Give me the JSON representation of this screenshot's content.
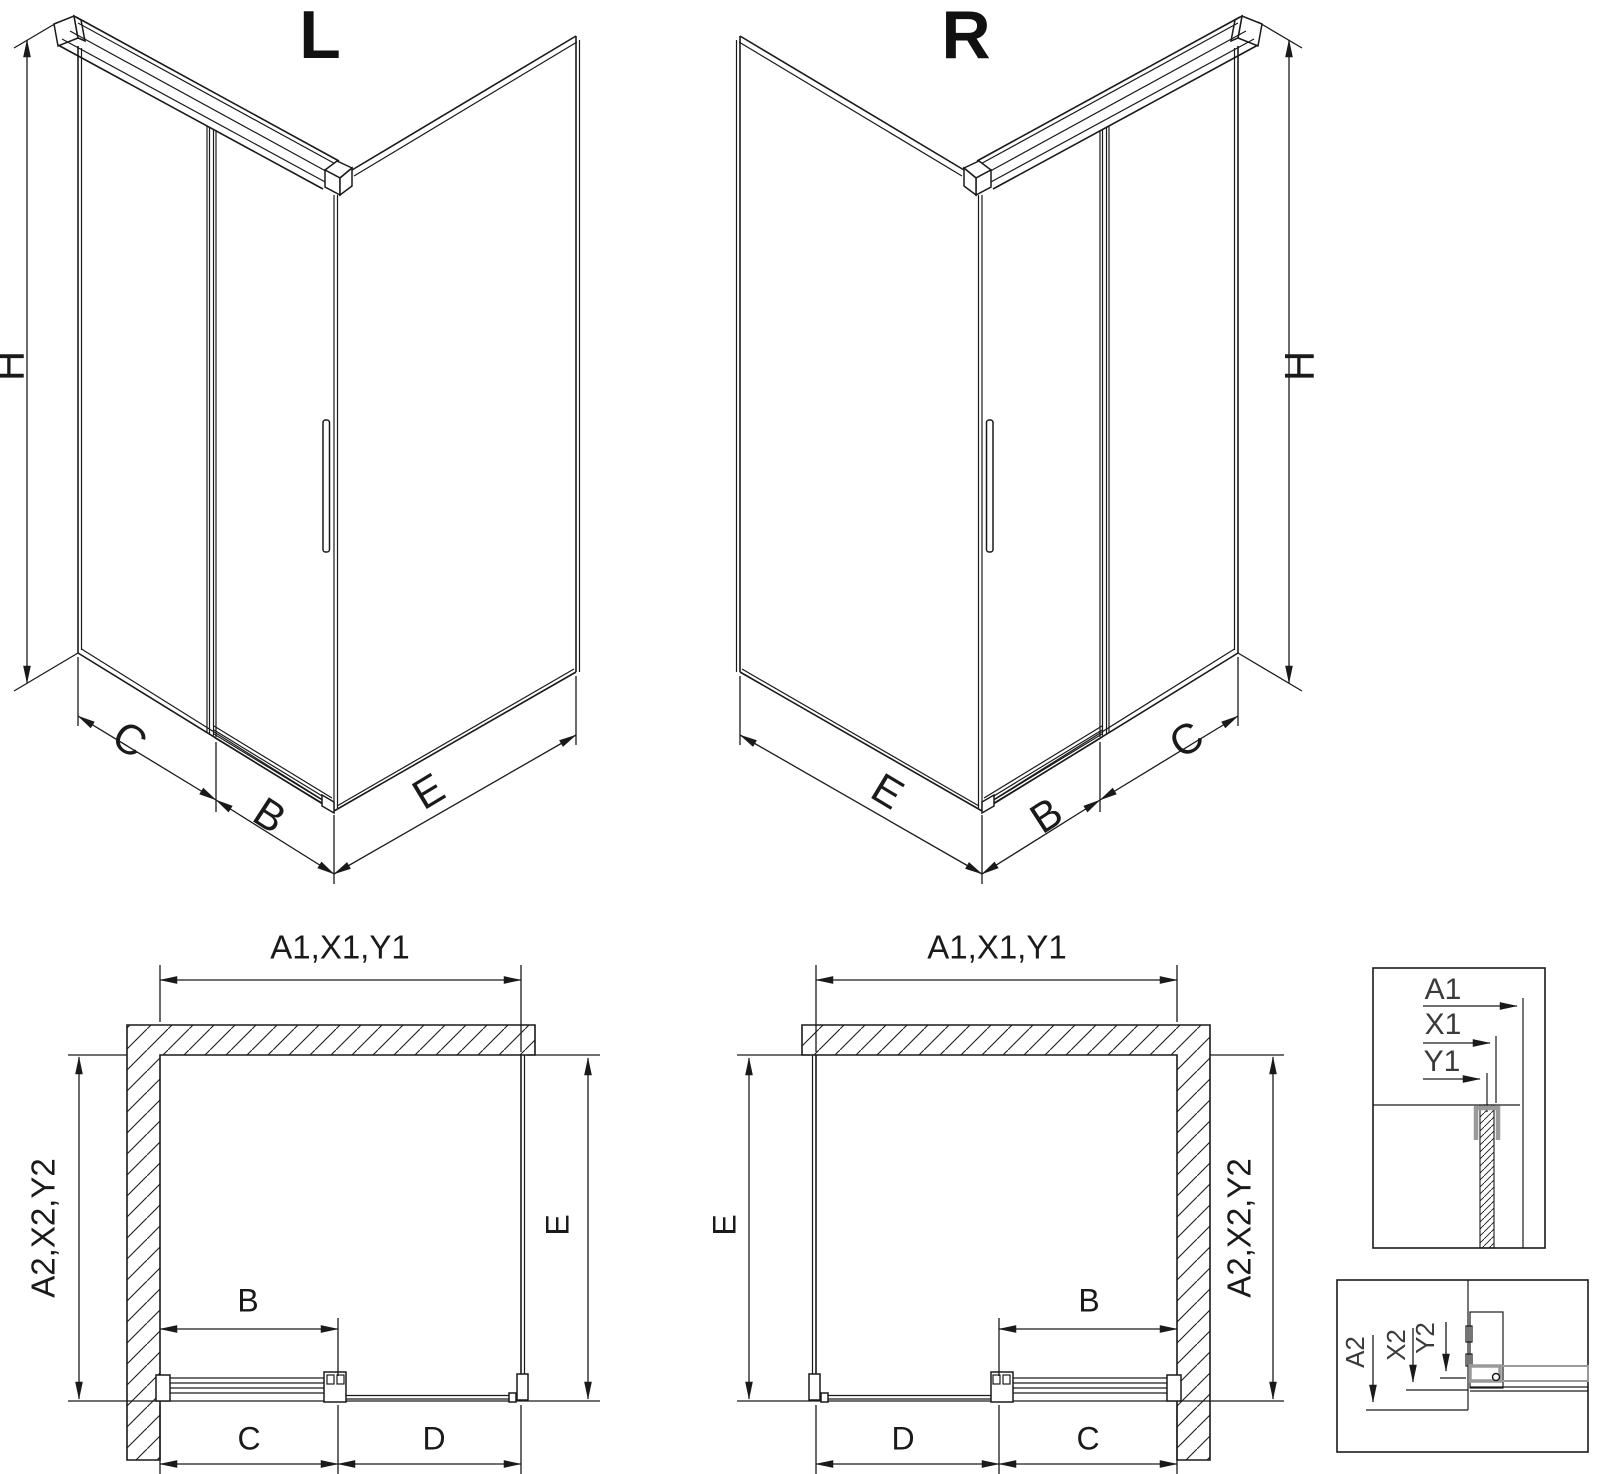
{
  "colors": {
    "ink": "#1a1a1a",
    "profile_gray": "#9a9a9a",
    "background": "#ffffff"
  },
  "iso_left": {
    "title": "L",
    "dim_height": "H",
    "dim_fixed": "C",
    "dim_door": "B",
    "dim_side": "E"
  },
  "iso_right": {
    "title": "R",
    "dim_height": "H",
    "dim_fixed": "C",
    "dim_door": "B",
    "dim_side": "E"
  },
  "plan_left": {
    "dim_top": "A1,X1,Y1",
    "dim_left": "A2,X2,Y2",
    "dim_side": "E",
    "dim_door": "B",
    "dim_bottom_inner": "C",
    "dim_bottom_outer": "D"
  },
  "plan_right": {
    "dim_top": "A1,X1,Y1",
    "dim_left": "E",
    "dim_right": "A2,X2,Y2",
    "dim_door": "B",
    "dim_bottom_outer": "D",
    "dim_bottom_inner": "C"
  },
  "detail_top": {
    "labels": [
      "A1",
      "X1",
      "Y1"
    ]
  },
  "detail_bottom": {
    "labels": [
      "A2",
      "X2",
      "Y2"
    ]
  }
}
